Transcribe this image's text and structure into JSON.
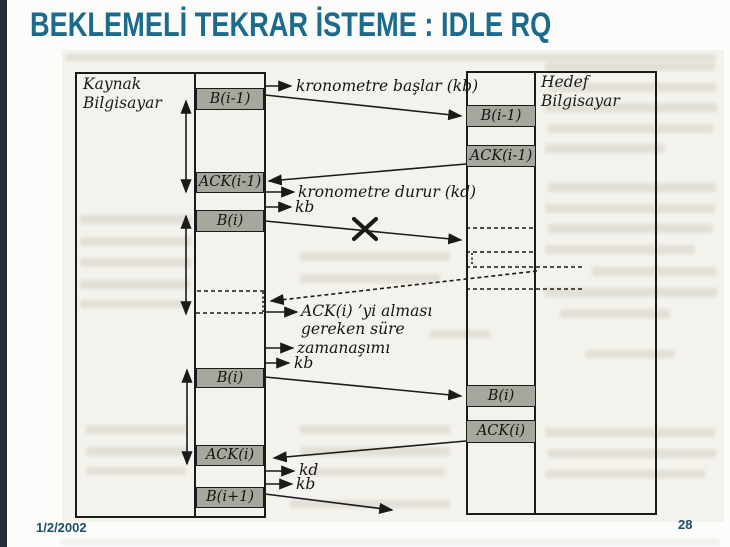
{
  "slide": {
    "title": "BEKLEMELİ TEKRAR İSTEME : IDLE RQ",
    "date": "1/2/2002",
    "page_number": "28"
  },
  "colors": {
    "accent": "#1d6b8c",
    "ink": "#1a1a1a",
    "box_fill": "#a8a79e",
    "scan_bg": "#f3f2ec",
    "edge_strip": "#262c39",
    "footer_text": "#1d4f66"
  },
  "diagram": {
    "source": {
      "label_line1": "Kaynak",
      "label_line2": "Bilgisayar",
      "boxes": [
        {
          "label": "B(i-1)"
        },
        {
          "label": "ACK(i-1)"
        },
        {
          "label": "B(i)"
        },
        {
          "label": "B(i)"
        },
        {
          "label": "ACK(i)"
        },
        {
          "label": "B(i+1)"
        }
      ]
    },
    "destination": {
      "label_line1": "Hedef",
      "label_line2": "Bilgisayar",
      "boxes": [
        {
          "label": "B(i-1)"
        },
        {
          "label": "ACK(i-1)"
        },
        {
          "label": "B(i)"
        },
        {
          "label": "ACK(i)"
        }
      ]
    },
    "annotations": {
      "timer_start": "kronometre başlar (kb)",
      "timer_stop": "kronometre durur (kd)",
      "kb_after_stop": "kb",
      "ack_wait_line1": "ACK(i) ’yi alması",
      "ack_wait_line2": "gereken süre",
      "timeout": "zamanaşımı",
      "kb_after_timeout": "kb",
      "kd_second": "kd",
      "kb_final": "kb"
    },
    "icons": {
      "lost_frame_marker": "x-cross"
    }
  }
}
